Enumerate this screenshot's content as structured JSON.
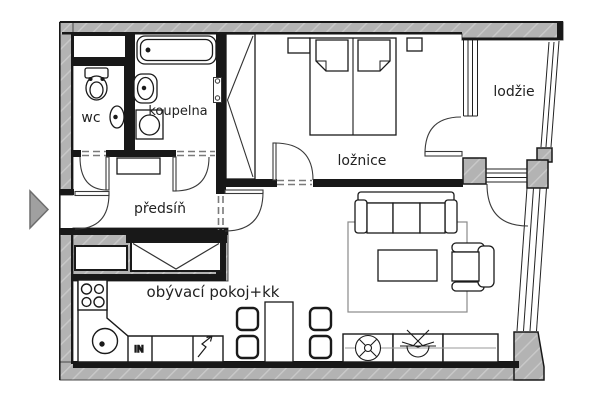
{
  "plan_title": "apartment floor plan",
  "rooms": [
    {
      "id": "wc",
      "label": "wc"
    },
    {
      "id": "koupelna",
      "label": "koupelna"
    },
    {
      "id": "predsin",
      "label": "předsíň"
    },
    {
      "id": "loznice",
      "label": "ložnice"
    },
    {
      "id": "lodzie",
      "label": "lodžie"
    },
    {
      "id": "obyvaci-pokoj",
      "label": "obývací pokoj+kk"
    }
  ],
  "annotations": {
    "kitchen_unit_label": "IN"
  },
  "colors": {
    "background": "#ffffff",
    "wall_fill": "#b3b3b3",
    "wall_hatch": "#c9c9c9",
    "wall_line": "#181818",
    "furniture_line": "#1a1a1a",
    "threshold_dash": "#7a7a7a",
    "rug_line": "#8a8a8a",
    "entry_arrow": "#a0a0a0"
  }
}
